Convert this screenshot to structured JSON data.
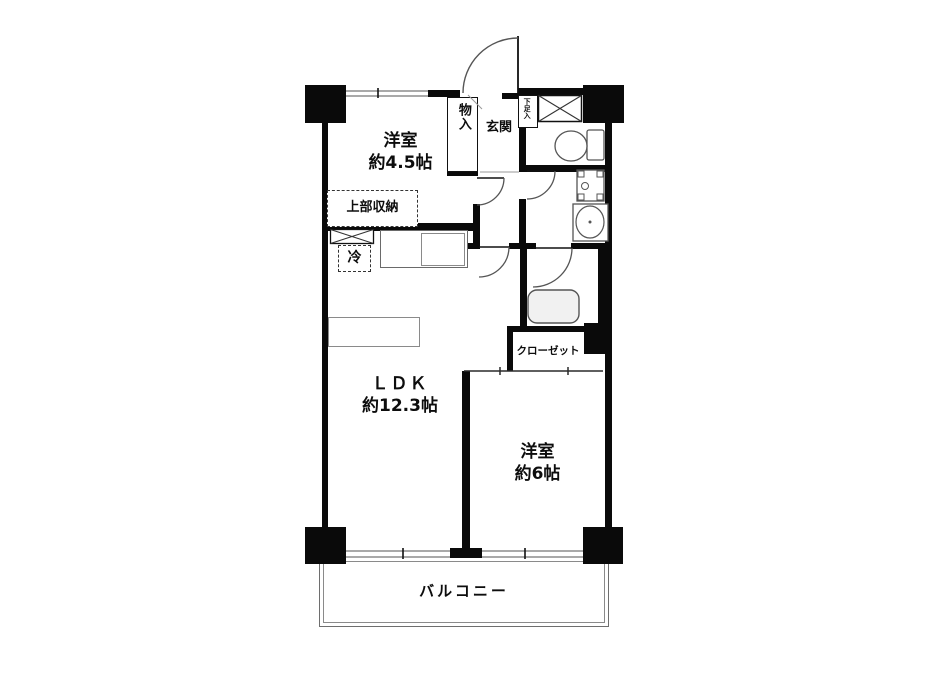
{
  "floorplan": {
    "labels": {
      "bedroom1_name": "洋室",
      "bedroom1_size": "約4.5帖",
      "ldk_name": "ＬＤＫ",
      "ldk_size": "約12.3帖",
      "bedroom2_name": "洋室",
      "bedroom2_size": "約6帖",
      "balcony": "バルコニー",
      "entrance": "玄関",
      "storage": "物入",
      "shoe_cabinet": "下足入",
      "upper_storage": "上部収納",
      "refrigerator": "冷",
      "closet": "クローゼット"
    },
    "colors": {
      "wall": "#0a0a0a",
      "window": "#a9a9a9",
      "fixture_line": "#555555",
      "background": "#ffffff"
    }
  }
}
